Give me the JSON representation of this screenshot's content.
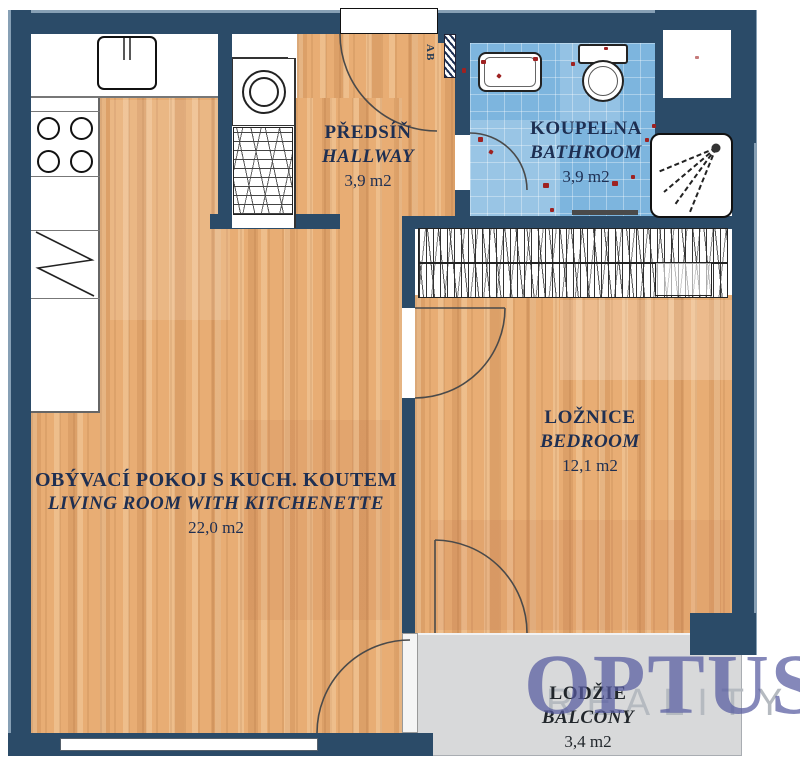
{
  "plan": {
    "rooms": [
      {
        "id": "hallway",
        "name_cs": "PŘEDSÍŇ",
        "name_en": "HALLWAY",
        "area": "3,9 m2"
      },
      {
        "id": "bathroom",
        "name_cs": "KOUPELNA",
        "name_en": "BATHROOM",
        "area": "3,9 m2"
      },
      {
        "id": "bedroom",
        "name_cs": "LOŽNICE",
        "name_en": "BEDROOM",
        "area": "12,1 m2"
      },
      {
        "id": "living",
        "name_cs": "OBÝVACÍ POKOJ S KUCH. KOUTEM",
        "name_en": "LIVING ROOM WITH KITCHENETTE",
        "area": "22,0 m2"
      },
      {
        "id": "balcony",
        "name_cs": "LODŽIE",
        "name_en": "BALCONY",
        "area": "3,4 m2"
      }
    ],
    "door_label": "AB",
    "fixtures": [
      "kitchen-sink-icon",
      "stove-icon",
      "fridge-icon",
      "washing-machine-icon",
      "laundry-cabinet-icon",
      "wardrobe-icon",
      "bathroom-sink-icon",
      "toilet-icon",
      "shower-icon",
      "shaft-niche"
    ],
    "colors": {
      "wall": "#2b4b68",
      "wood": "#e8ad74",
      "tile": "#7db5de",
      "balcony": "#d8d9da",
      "label": "#1e2f52",
      "accent_red": "#9e2222",
      "watermark": "#565aa0",
      "watermark_gray": "#b5bac0"
    }
  },
  "watermark": {
    "brand": "OPTUS",
    "subtitle": "REALITY"
  }
}
